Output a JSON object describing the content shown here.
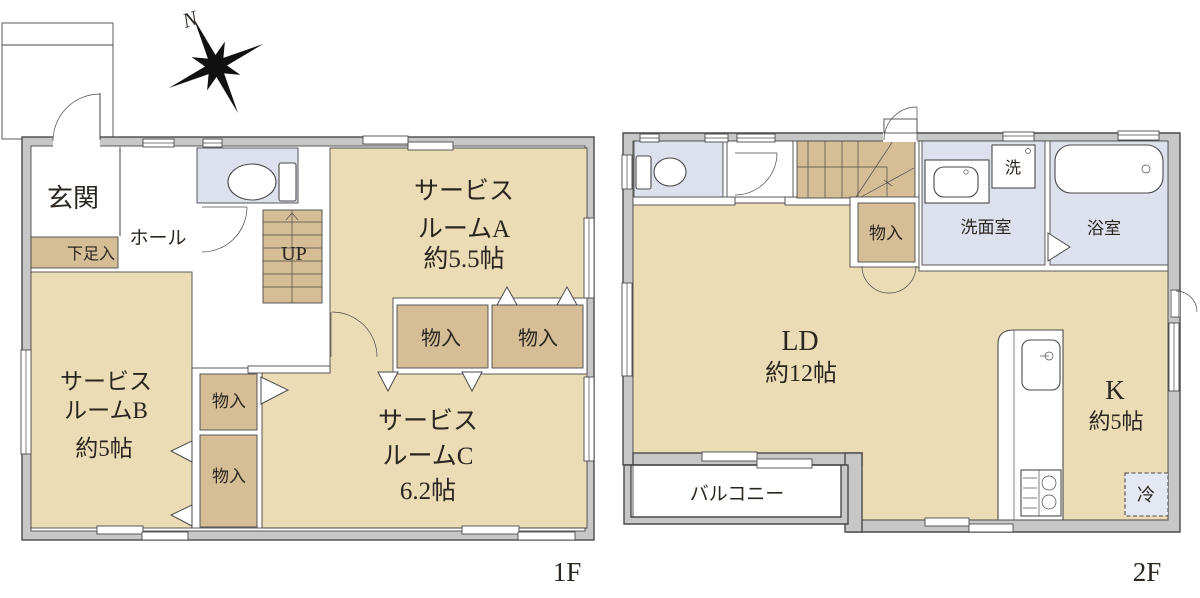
{
  "palette": {
    "floor": "#ecdcb6",
    "closet": "#d5bd95",
    "wet_area": "#dde1ed",
    "wall": "#c7c7c7",
    "line": "#4a4a4a",
    "text": "#2b2520"
  },
  "compass": {
    "north": "N"
  },
  "floor1": {
    "label": "1F",
    "entrance": "玄関",
    "hall": "ホール",
    "shoe_storage": "下足入",
    "stairs_up": "UP",
    "room_a": {
      "line1": "サービス",
      "line2": "ルームA",
      "line3": "約5.5帖"
    },
    "room_b": {
      "line1": "サービス",
      "line2": "ルームB",
      "line3": "約5帖"
    },
    "room_c": {
      "line1": "サービス",
      "line2": "ルームC",
      "line3": "6.2帖"
    },
    "closet_a1": "物入",
    "closet_a2": "物入",
    "closet_b1": "物入",
    "closet_b2": "物入"
  },
  "floor2": {
    "label": "2F",
    "ld": {
      "line1": "LD",
      "line2": "約12帖"
    },
    "kitchen": {
      "line1": "K",
      "line2": "約5帖"
    },
    "washroom": "洗面室",
    "bathroom": "浴室",
    "washer": "洗",
    "closet": "物入",
    "balcony": "バルコニー",
    "fridge": "冷"
  }
}
